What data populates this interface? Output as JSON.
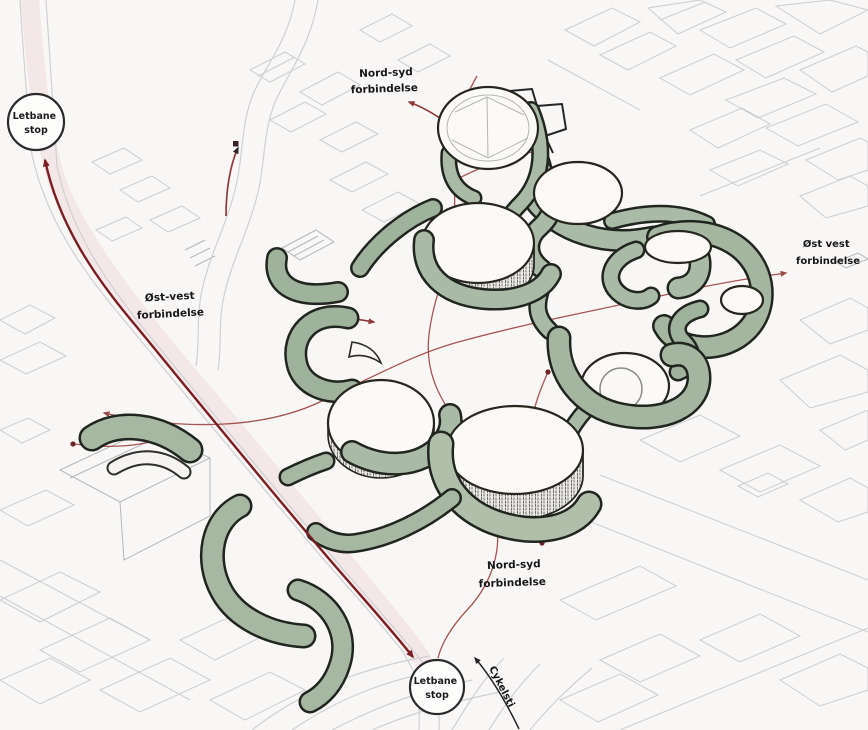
{
  "labels": {
    "letbane_top": {
      "line1": "Letbane",
      "line2": "stop"
    },
    "letbane_bottom": {
      "line1": "Letbane",
      "line2": "stop"
    },
    "nordsyd_top": {
      "line1": "Nord-syd",
      "line2": "forbindelse"
    },
    "nordsyd_bottom": {
      "line1": "Nord-syd",
      "line2": "forbindelse"
    },
    "ostvest_left": {
      "line1": "Øst-vest",
      "line2": "forbindelse"
    },
    "ostvest_right": {
      "line1": "Øst vest",
      "line2": "forbindelse"
    },
    "cykelsti": "Cykelsti"
  },
  "colors": {
    "paper": "#f8f7f5",
    "landscape_green": "#a9bba6",
    "ink_outline": "#21251f",
    "rail_red": "#7b1e24",
    "path_red": "#9c4343",
    "context_gray": "#c7c9ce"
  }
}
